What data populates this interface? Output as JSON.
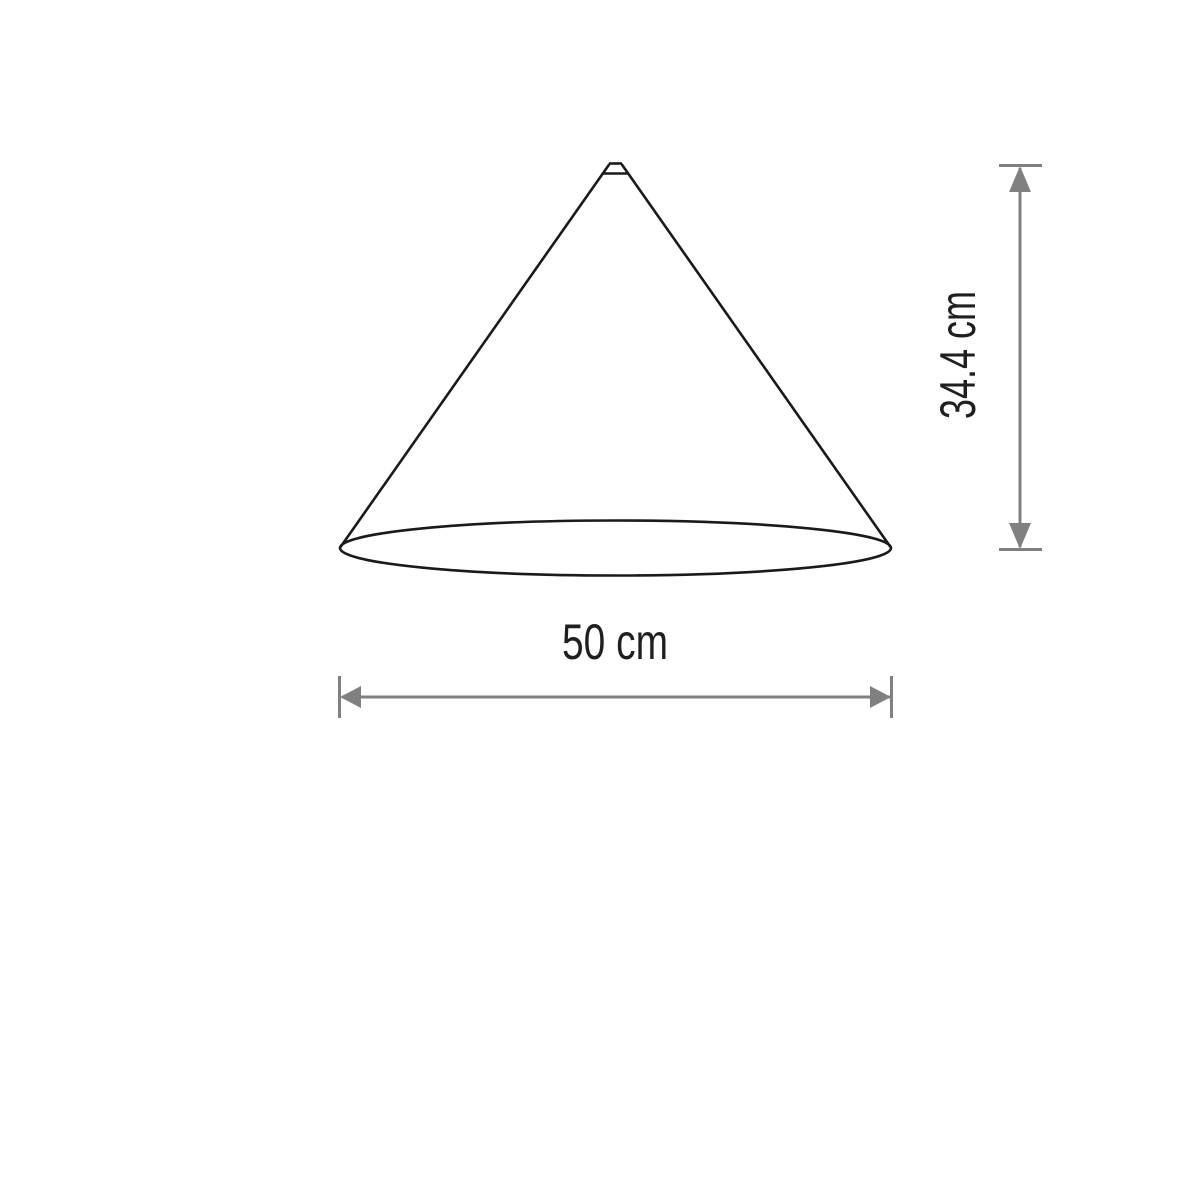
{
  "diagram": {
    "type": "product-dimension-drawing",
    "subject": "cone-lampshade",
    "dimensions": {
      "width": {
        "label": "50 cm",
        "value": 50,
        "unit": "cm",
        "orientation": "horizontal"
      },
      "height": {
        "label": "34.4 cm",
        "value": 34.4,
        "unit": "cm",
        "orientation": "vertical"
      }
    },
    "colors": {
      "outline": "#1a1a1a",
      "dimension_lines": "#808080",
      "label_text": "#1f1f1f",
      "background": "#ffffff"
    }
  }
}
